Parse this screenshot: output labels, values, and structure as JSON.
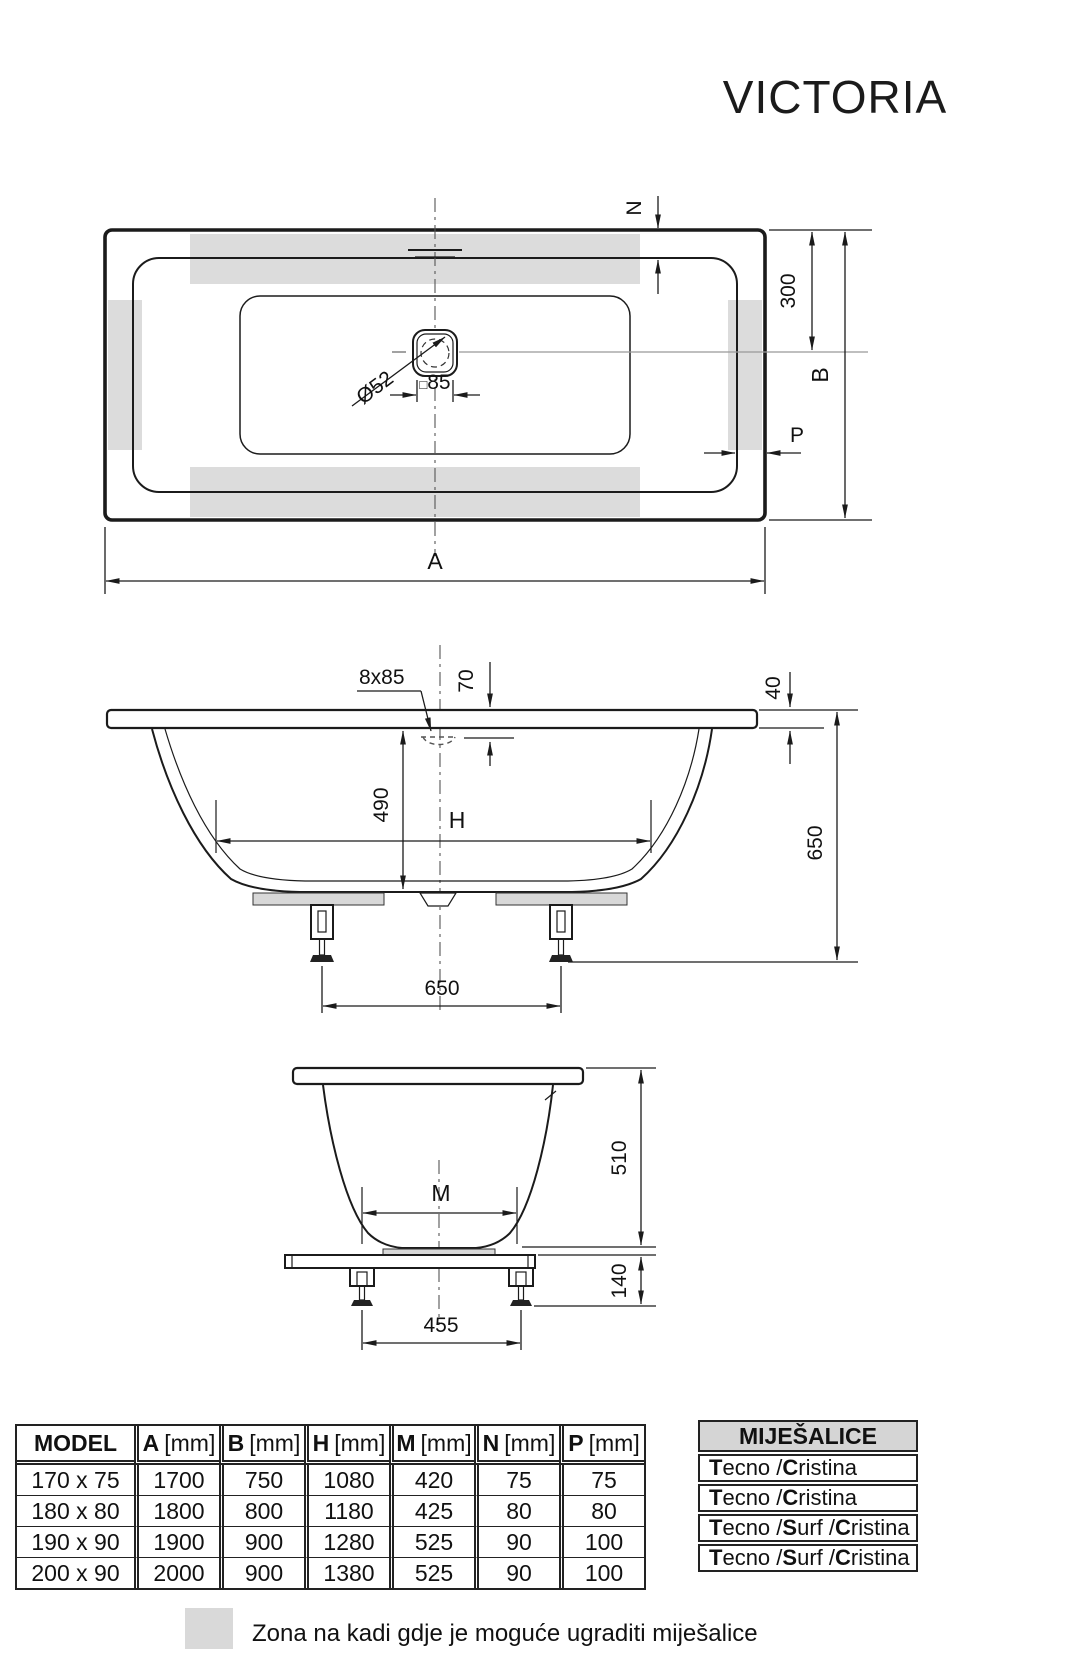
{
  "title": "VICTORIA",
  "top_view": {
    "dim_n": "N",
    "dim_300": "300",
    "dim_b": "B",
    "dim_p": "P",
    "dim_a": "A",
    "drain_diameter": "Ø52",
    "drain_square_symbol": "□",
    "drain_square_value": "85"
  },
  "side_view": {
    "overflow": "8x85",
    "dim_70": "70",
    "dim_490": "490",
    "dim_h": "H",
    "dim_40": "40",
    "dim_650_height": "650",
    "dim_650_feet": "650"
  },
  "end_view": {
    "dim_m": "M",
    "dim_510": "510",
    "dim_140": "140",
    "dim_455": "455"
  },
  "dims_table": {
    "headers": [
      {
        "label": "MODEL",
        "unit": ""
      },
      {
        "label": "A",
        "unit": "[mm]"
      },
      {
        "label": "B",
        "unit": "[mm]"
      },
      {
        "label": "H",
        "unit": "[mm]"
      },
      {
        "label": "M",
        "unit": "[mm]"
      },
      {
        "label": "N",
        "unit": "[mm]"
      },
      {
        "label": "P",
        "unit": "[mm]"
      }
    ],
    "rows": [
      {
        "model": "170 x 75",
        "a": "1700",
        "b": "750",
        "h": "1080",
        "m": "420",
        "n": "75",
        "p": "75"
      },
      {
        "model": "180 x 80",
        "a": "1800",
        "b": "800",
        "h": "1180",
        "m": "425",
        "n": "80",
        "p": "80"
      },
      {
        "model": "190 x 90",
        "a": "1900",
        "b": "900",
        "h": "1280",
        "m": "525",
        "n": "90",
        "p": "100"
      },
      {
        "model": "200 x 90",
        "a": "2000",
        "b": "900",
        "h": "1380",
        "m": "525",
        "n": "90",
        "p": "100"
      }
    ]
  },
  "mixers_table": {
    "title": "MIJEŠALICE",
    "rows": [
      {
        "segments": [
          [
            "T",
            true
          ],
          [
            "ecno / ",
            false
          ],
          [
            "C",
            true
          ],
          [
            "ristina",
            false
          ]
        ]
      },
      {
        "segments": [
          [
            "T",
            true
          ],
          [
            "ecno / ",
            false
          ],
          [
            "C",
            true
          ],
          [
            "ristina",
            false
          ]
        ]
      },
      {
        "segments": [
          [
            "T",
            true
          ],
          [
            "ecno / ",
            false
          ],
          [
            "S",
            true
          ],
          [
            "urf / ",
            false
          ],
          [
            "C",
            true
          ],
          [
            "ristina",
            false
          ]
        ]
      },
      {
        "segments": [
          [
            "T",
            true
          ],
          [
            "ecno / ",
            false
          ],
          [
            "S",
            true
          ],
          [
            "urf / ",
            false
          ],
          [
            "C",
            true
          ],
          [
            "ristina",
            false
          ]
        ]
      }
    ]
  },
  "legend": {
    "text": "Zona na kadi gdje je moguće ugraditi miješalice"
  },
  "colors": {
    "zone_gray": "#dcdcdc",
    "header_gray": "#d5d5d5",
    "line": "#1b1b1b"
  }
}
